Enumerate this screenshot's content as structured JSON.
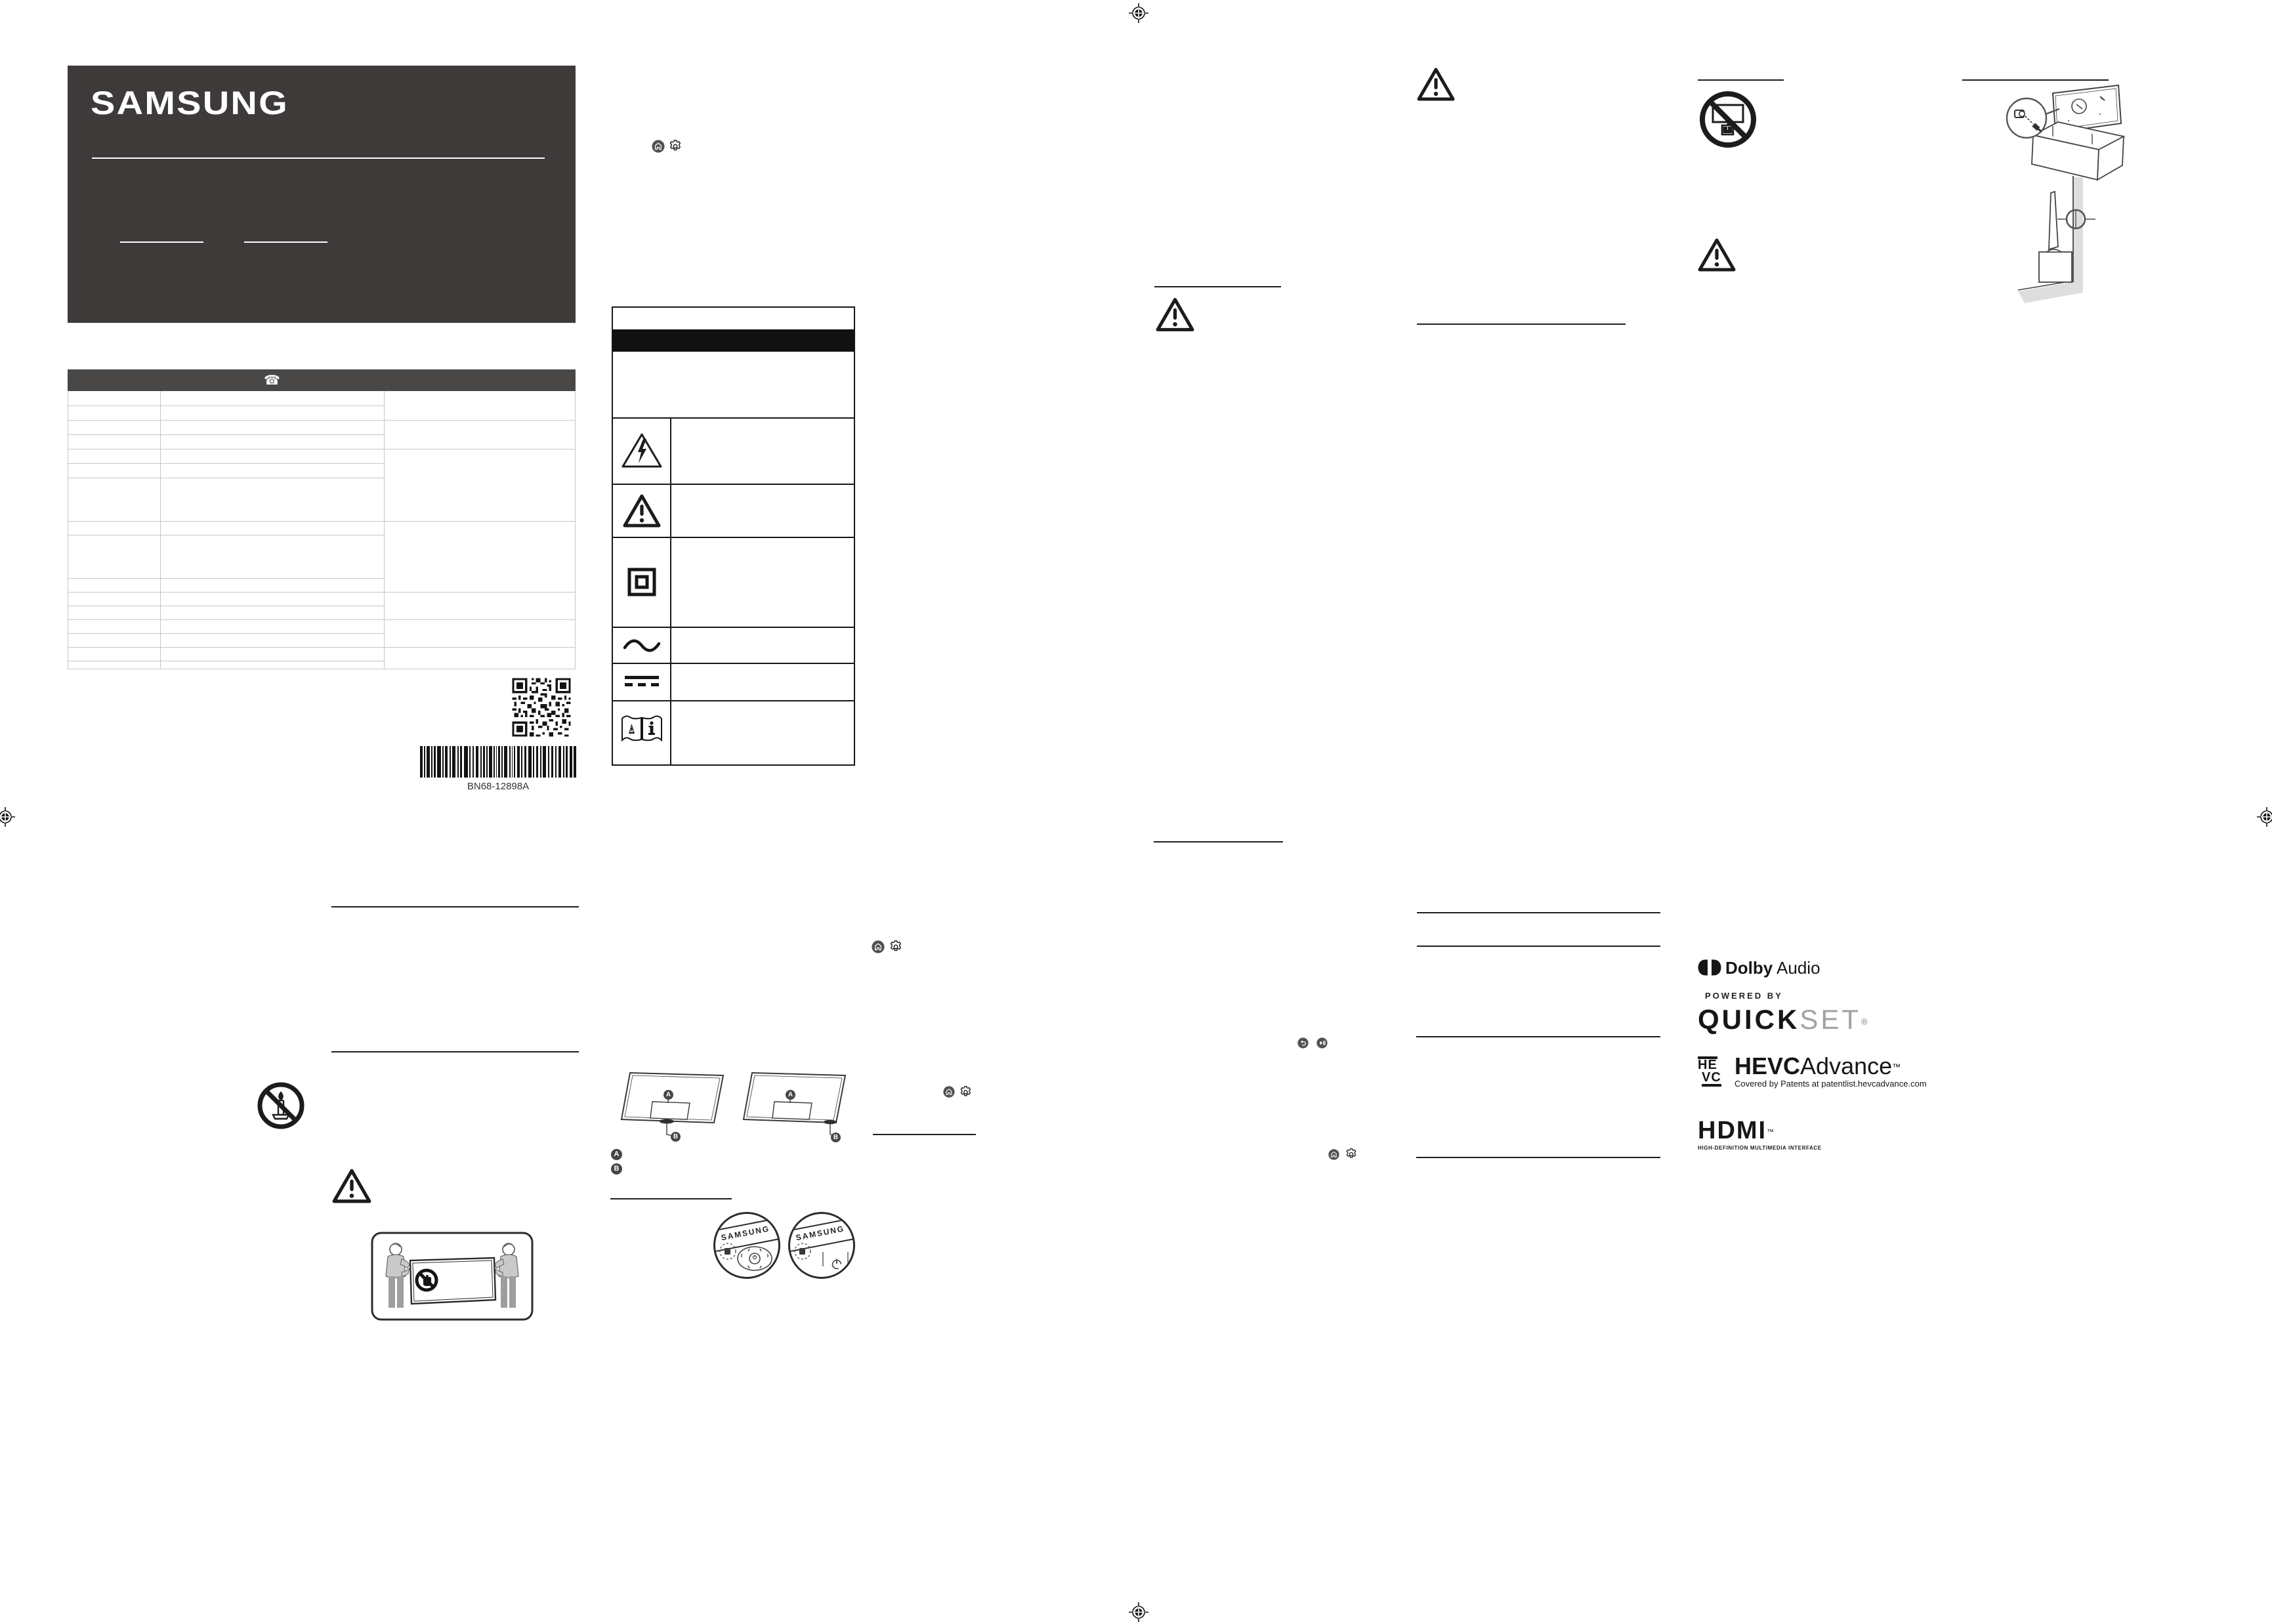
{
  "page": {
    "part_number": "BN68-12898A"
  },
  "brand": {
    "samsung": "SAMSUNG"
  },
  "contact_table": {
    "phone_icon": "☎"
  },
  "stand_legend": {
    "a": "A",
    "b": "B"
  },
  "insets": {
    "samsung_label": "SAMSUNG"
  },
  "logos": {
    "dolby": {
      "name": "Dolby",
      "type": "Audio"
    },
    "quickset": {
      "powered_by": "POWERED BY",
      "quick": "QUICK",
      "set": "SET",
      "reg": "®"
    },
    "hevc": {
      "glyph_top": "HE",
      "glyph_bottom": "VC",
      "name_bold": "HEVC",
      "name_light": "Advance",
      "tm": "™",
      "caption": "Covered by Patents at patentlist.hevcadvance.com"
    },
    "hdmi": {
      "name": "HDMI",
      "tm": "™",
      "caption": "HIGH-DEFINITION MULTIMEDIA INTERFACE"
    }
  },
  "colors": {
    "ink": "#1a1a1a",
    "panel_dark": "#3e3a3a",
    "table_header": "#4a4747",
    "light_line": "#c6c6c6",
    "icon_circle": "#525050",
    "quickset_set_gray": "#a2a2a2",
    "wall_gray": "#dedede"
  }
}
